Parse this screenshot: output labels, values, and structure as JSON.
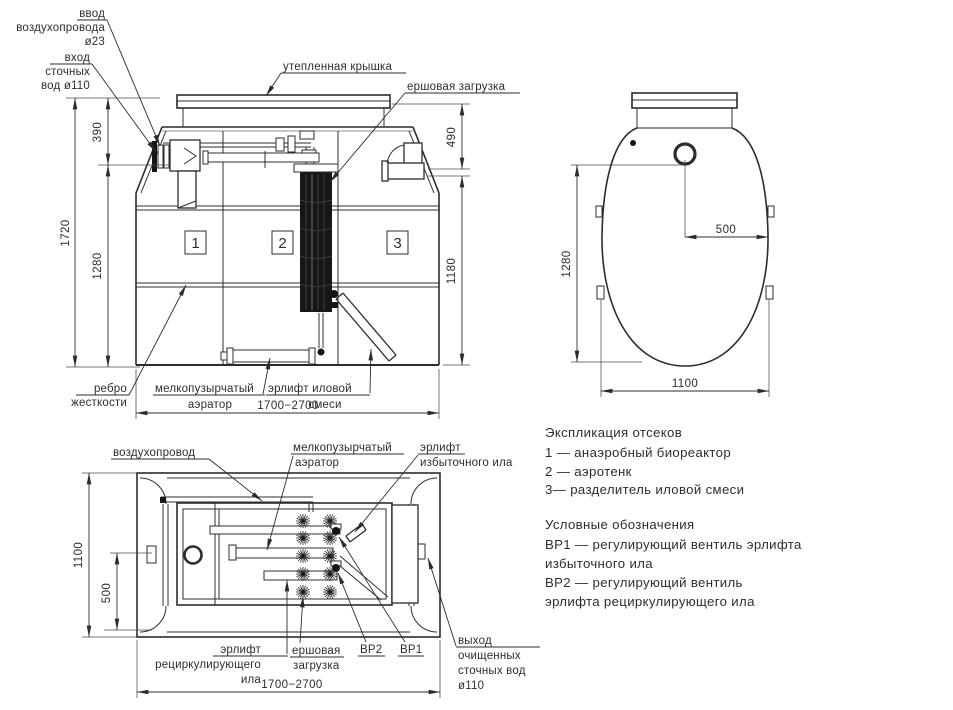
{
  "front_view": {
    "callouts": {
      "air_inlet": [
        "ввод",
        "воздухопровода",
        "ø23"
      ],
      "sewage_inlet": [
        "вход",
        "сточных",
        "вод ø110"
      ],
      "insulated_cover": "утепленная крышка",
      "brush_media": "ершовая загрузка",
      "stiffening_rib": [
        "ребро",
        "жесткости"
      ],
      "fine_bubble_aerator": [
        "мелкопузырчатый",
        "аэратор"
      ],
      "sludge_mix_airlift": [
        "эрлифт иловой",
        "смеси"
      ]
    },
    "compartments": [
      "1",
      "2",
      "3"
    ],
    "dims": {
      "total_height": "1720",
      "inlet_depth": "390",
      "body_height": "1280",
      "neck_height": "490",
      "inner_height": "1180",
      "length_range": "1700−2700"
    }
  },
  "side_view": {
    "dims": {
      "body_height": "1280",
      "outlet_offset": "500",
      "width": "1100"
    }
  },
  "plan_view": {
    "callouts": {
      "air_duct": "воздухопровод",
      "fine_bubble_aerator": [
        "мелкопузырчатый",
        "аэратор"
      ],
      "excess_sludge_airlift": [
        "эрлифт",
        "избыточного ила"
      ],
      "recirculating_sludge_airlift": [
        "эрлифт",
        "рециркулирующего",
        "ила"
      ],
      "brush_media": [
        "ершовая",
        "загрузка"
      ],
      "valve_vr2": "ВР2",
      "valve_vr1": "ВР1",
      "treated_water_outlet": [
        "выход",
        "очищенных",
        "сточных вод",
        "ø110"
      ]
    },
    "dims": {
      "width": "1100",
      "half_width": "500",
      "length_range": "1700−2700"
    }
  },
  "legend": {
    "compartments_title": "Экспликация отсеков",
    "compartment_items": [
      "1 —  анаэробный биореактор",
      "2 —  аэротенк",
      "3—  разделитель иловой смеси"
    ],
    "symbols_title": "Условные обозначения",
    "symbol_lines": [
      "ВР1 —  регулирующий вентиль эрлифта",
      "избыточного ила",
      "ВР2 —  регулирующий вентиль",
      "эрлифта рециркулирующего ила"
    ]
  },
  "colors": {
    "line": "#2c2c2c",
    "text": "#2d2d2d",
    "media_fill": "#161616",
    "background": "#ffffff"
  }
}
